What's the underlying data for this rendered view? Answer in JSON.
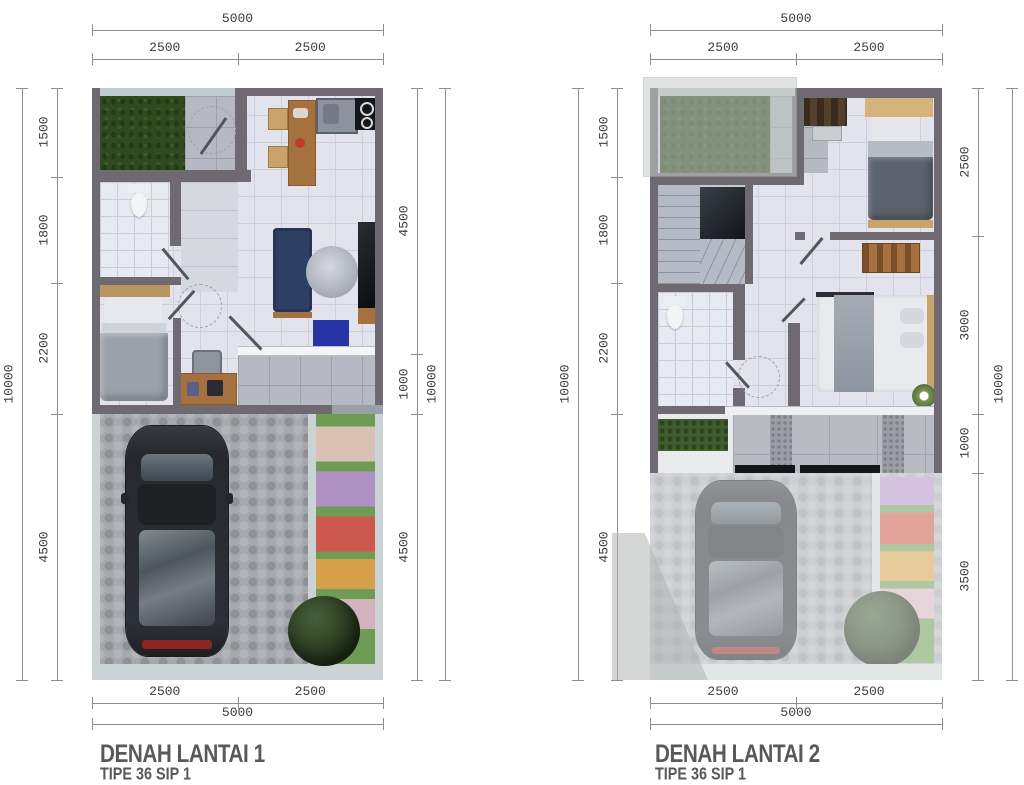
{
  "page": {
    "background": "#ffffff"
  },
  "palette": {
    "wall": "#6f6a72",
    "dim_line": "#8e8e90",
    "dim_text": "#3c3c3e",
    "title_text": "#59595b",
    "floor_tile": "#e2e3ec",
    "grass": "#2f4a1e",
    "paver": "#a6a8ad",
    "sofa": "#2e3f63",
    "wood": "#a5713f"
  },
  "plan1": {
    "title": "DENAH LANTAI 1",
    "subtitle": "TIPE 36 SIP 1",
    "dims": {
      "top_total": [
        "5000"
      ],
      "top_segments": [
        "2500",
        "2500"
      ],
      "left_outer": [
        "10000"
      ],
      "left_segments": [
        "1500",
        "1800",
        "2200",
        "4500"
      ],
      "right_segments": [
        "4500",
        "1000",
        "4500"
      ],
      "right_outer": [
        "10000"
      ],
      "bottom_segments": [
        "2500",
        "2500"
      ],
      "bottom_total": [
        "5000"
      ]
    }
  },
  "plan2": {
    "title": "DENAH LANTAI 2",
    "subtitle": "TIPE 36 SIP 1",
    "dims": {
      "top_total": [
        "5000"
      ],
      "top_segments": [
        "2500",
        "2500"
      ],
      "left_outer": [
        "10000"
      ],
      "left_segments": [
        "1500",
        "1800",
        "2200",
        "4500"
      ],
      "right_segments": [
        "2500",
        "3000",
        "1000",
        "3500"
      ],
      "right_outer": [
        "10000"
      ],
      "bottom_segments": [
        "2500",
        "2500"
      ],
      "bottom_total": [
        "5000"
      ]
    }
  }
}
